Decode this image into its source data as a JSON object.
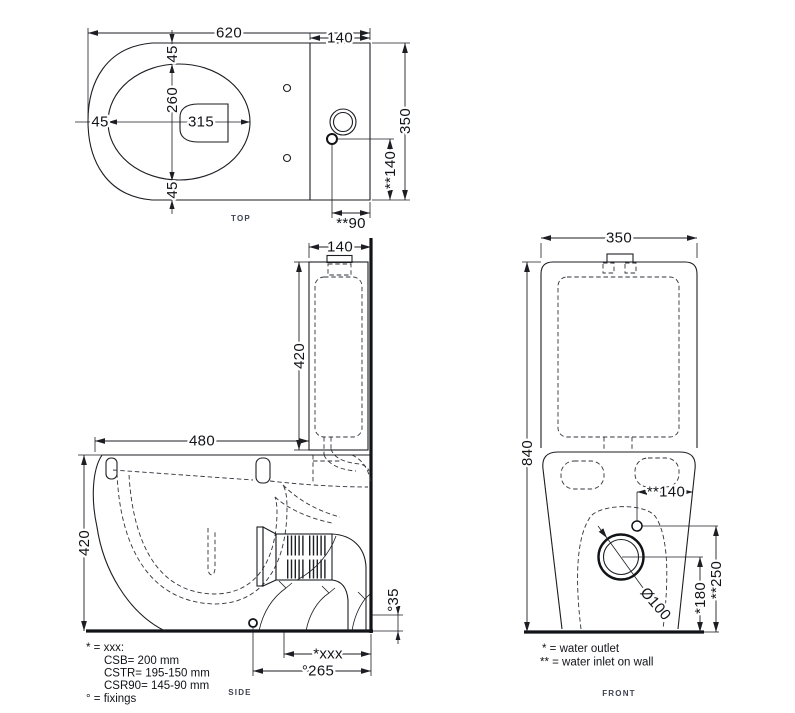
{
  "colors": {
    "line": "#1c1e23",
    "text": "#111317",
    "view_label": "#3d4350",
    "background": "#ffffff"
  },
  "views": {
    "top": {
      "label": "TOP",
      "dims": {
        "overall_length": "620",
        "tank_depth": "140",
        "overall_width": "350",
        "rim_offset_top": "45",
        "rim_width": "260",
        "rim_offset_left": "45",
        "rim_length": "315",
        "rim_offset_bottom": "45",
        "inlet_offset_side": "**140",
        "inlet_offset_back": "**90"
      }
    },
    "side": {
      "label": "SIDE",
      "dims": {
        "tank_depth": "140",
        "tank_height": "420",
        "bowl_depth": "480",
        "bowl_height": "420",
        "fixing_height": "°35",
        "outlet_distance": "*xxx",
        "fixing_distance": "°265"
      }
    },
    "front": {
      "label": "FRONT",
      "dims": {
        "overall_width": "350",
        "overall_height": "840",
        "inlet_offset": "**140",
        "inlet_height": "**250",
        "outlet_height": "*180",
        "outlet_diameter": "Ø100"
      }
    }
  },
  "legends": {
    "side": {
      "line1": "* = xxx:",
      "line2": "CSB= 200 mm",
      "line3": "CSTR= 195-150 mm",
      "line4": "CSR90=  145-90 mm",
      "line5": "° = fixings"
    },
    "front": {
      "line1": "* = water outlet",
      "line2": "** = water inlet on wall"
    }
  }
}
